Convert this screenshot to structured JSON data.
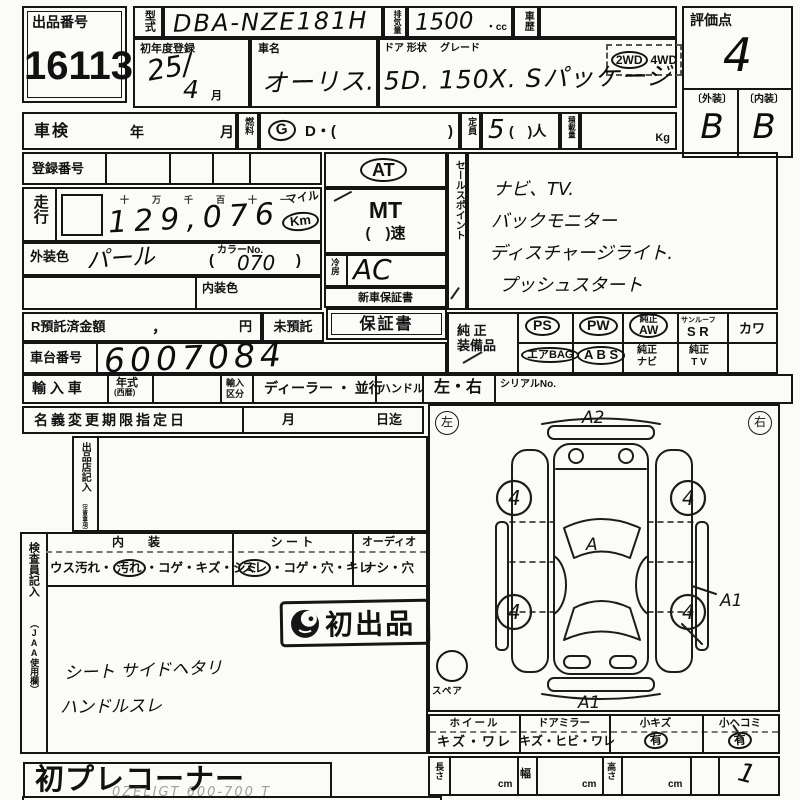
{
  "lot": {
    "label": "出品番号",
    "number": "16113"
  },
  "model": {
    "label": "型式",
    "value": "DBA-NZE181H"
  },
  "disp": {
    "label": "排気量",
    "value": "1500",
    "unit": "・cc"
  },
  "history": {
    "label": "車歴"
  },
  "score": {
    "label": "評価点",
    "value": "4",
    "ext_label": "〔外装〕",
    "int_label": "〔内装〕",
    "ext": "B",
    "int": "B"
  },
  "reg1": {
    "label": "初年度登録",
    "v1": "25/",
    "v2": "4",
    "month": "月"
  },
  "car": {
    "label": "車名",
    "door": "ドア 形状",
    "grade": "グレード",
    "value": "オーリス. 5D. 150X. Sパッケージ"
  },
  "drive": {
    "wd2": "2WD",
    "wd4": "4WD"
  },
  "shaken": {
    "label": "車検",
    "year": "年",
    "month": "月"
  },
  "fuel": {
    "label": "燃料",
    "g": "G",
    "d": "D・(",
    "close": ")"
  },
  "cap": {
    "label": "定員",
    "value": "5",
    "suffix": "(　)人"
  },
  "load": {
    "label": "積載量",
    "unit": "Kg"
  },
  "regno": {
    "label": "登録番号"
  },
  "run": {
    "label": "走行",
    "digits": "十万千百十一",
    "mile": "マイル",
    "km": "Km",
    "value": "129,076"
  },
  "ecolor": {
    "label": "外装色",
    "value": "パール",
    "no_label": "カラーNo.",
    "open": "(",
    "no": "070",
    "close": ")"
  },
  "icolor": {
    "label": "内装色"
  },
  "trans": {
    "at": "AT",
    "mt": "MT",
    "speed": "(　)速"
  },
  "ac": {
    "label": "冷房",
    "value": "AC"
  },
  "warr": {
    "new": "新車保証書",
    "book": "保証書"
  },
  "sales": {
    "label": "セールスポイント",
    "lines": [
      "ナビ、TV.",
      "バックモニター",
      "ディスチャージライト.",
      "プッシュスタート"
    ]
  },
  "equip": {
    "label1": "純 正",
    "label2": "装備品",
    "ps": "PS",
    "pw": "PW",
    "aw_top": "純正",
    "aw_bot": "AW",
    "sun": "サンルーフ",
    "sr": "S R",
    "kawa": "カワ",
    "airbag": "エアBAG",
    "abs": "A B S",
    "navi_top": "純正",
    "navi_bot": "ナビ",
    "tv_top": "純正",
    "tv_bot": "T V"
  },
  "deposit": {
    "label": "R預託済金額",
    "comma": "，",
    "yen": "円",
    "none": "未預託"
  },
  "chassis": {
    "label": "車台番号",
    "value": "6007084"
  },
  "imp": {
    "label": "輸 入 車",
    "year": "年式",
    "year_sub": "(西暦)",
    "cls_top": "輸入",
    "cls_bot": "区分",
    "dealer": "ディーラー ・ 並行",
    "handle": "ハンドル",
    "lr": "左・右",
    "serial": "シリアルNo."
  },
  "rename": {
    "label": "名義変更期限指定日",
    "month": "月",
    "until": "日迄"
  },
  "seller": {
    "label": "出品店記入",
    "sub": "（注意事項）"
  },
  "cond": {
    "int_h": "内　装",
    "int_a": "ウス汚れ・",
    "int_c": "汚れ",
    "int_b": "・コゲ・キズ・シミ",
    "seat_h": "シ ー ト",
    "seat_c": "スレ",
    "seat_b": "・コゲ・穴・キレ",
    "audio_h": "オーディオ",
    "audio_v": "ナシ・穴"
  },
  "insp": {
    "label": "検査員記入",
    "sub": "（JAA使用欄）",
    "stamp": "初出品",
    "note1": "シート サイドヘタリ",
    "note2": "ハンドルスレ"
  },
  "diag": {
    "left": "左",
    "right": "右",
    "spare": "スペア",
    "a2": "A2",
    "a_mid": "A",
    "a1_bottom": "A1",
    "a1_side": "A1",
    "w1": "4",
    "w2": "4",
    "w3": "4",
    "w4": "4"
  },
  "dmg": {
    "wheel_h": "ホイール",
    "wheel_v": "キズ・ワレ",
    "mir_h": "ドアミラー",
    "mir_v": "キズ・ヒビ・ワレ",
    "scr_h": "小キズ",
    "scr_v": "有",
    "dent_h": "小ヘコミ",
    "dent_v": "有"
  },
  "dims": {
    "len": "長さ",
    "wid": "幅",
    "hei": "高さ",
    "cm1": "cm",
    "cm2": "cm",
    "cm3": "cm",
    "mark": "1"
  },
  "footer": {
    "corner": "初プレコーナー",
    "faint": "0ZELIGT 600-700 T"
  }
}
